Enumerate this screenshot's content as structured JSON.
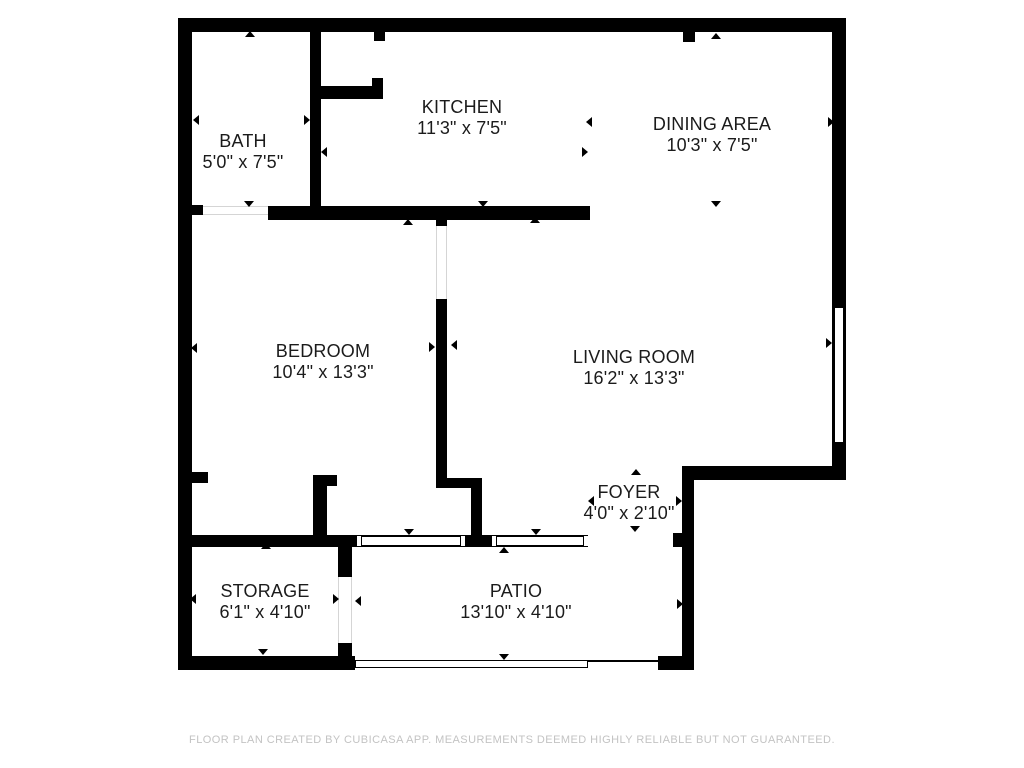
{
  "footer": {
    "disclaimer": "FLOOR PLAN CREATED BY CUBICASA APP. MEASUREMENTS DEEMED HIGHLY RELIABLE BUT NOT GUARANTEED."
  },
  "colors": {
    "wall": "#000000",
    "background": "#ffffff",
    "label_text": "#1b1b1b",
    "disclaimer_text": "#c3c3c3",
    "door_outline": "#d5d5d5"
  },
  "rooms": [
    {
      "id": "bath",
      "name": "BATH",
      "dims": "5'0\" x 7'5\"",
      "cx": 243,
      "cy": 152
    },
    {
      "id": "kitchen",
      "name": "KITCHEN",
      "dims": "11'3\" x 7'5\"",
      "cx": 462,
      "cy": 118
    },
    {
      "id": "dining-area",
      "name": "DINING AREA",
      "dims": "10'3\" x 7'5\"",
      "cx": 712,
      "cy": 135
    },
    {
      "id": "bedroom",
      "name": "BEDROOM",
      "dims": "10'4\" x 13'3\"",
      "cx": 323,
      "cy": 362
    },
    {
      "id": "living-room",
      "name": "LIVING ROOM",
      "dims": "16'2\" x 13'3\"",
      "cx": 634,
      "cy": 368
    },
    {
      "id": "foyer",
      "name": "FOYER",
      "dims": "4'0\" x 2'10\"",
      "cx": 629,
      "cy": 503
    },
    {
      "id": "storage",
      "name": "STORAGE",
      "dims": "6'1\" x 4'10\"",
      "cx": 265,
      "cy": 602
    },
    {
      "id": "patio",
      "name": "PATIO",
      "dims": "13'10\" x 4'10\"",
      "cx": 516,
      "cy": 602
    }
  ],
  "walls": [
    {
      "id": "top-wall",
      "x": 178,
      "y": 18,
      "w": 668,
      "h": 14
    },
    {
      "id": "left-wall",
      "x": 178,
      "y": 18,
      "w": 14,
      "h": 652
    },
    {
      "id": "right-wall-upper",
      "x": 832,
      "y": 18,
      "w": 14,
      "h": 285
    },
    {
      "id": "right-wall-lower",
      "x": 832,
      "y": 447,
      "w": 14,
      "h": 33
    },
    {
      "id": "foyer-step-wall",
      "x": 683,
      "y": 466,
      "w": 163,
      "h": 14
    },
    {
      "id": "foyer-right-wall",
      "x": 682,
      "y": 466,
      "w": 12,
      "h": 204
    },
    {
      "id": "entry-foot-wall",
      "x": 658,
      "y": 656,
      "w": 36,
      "h": 14
    },
    {
      "id": "storage-bottom-wall",
      "x": 178,
      "y": 656,
      "w": 177,
      "h": 14
    },
    {
      "id": "bath-kitchen-wall",
      "x": 310,
      "y": 32,
      "w": 11,
      "h": 174
    },
    {
      "id": "kitchen-closet-wall",
      "x": 321,
      "y": 86,
      "w": 62,
      "h": 13
    },
    {
      "id": "kitchen-closet-jamb",
      "x": 372,
      "y": 78,
      "w": 11,
      "h": 21
    },
    {
      "id": "kitchen-closet-stub",
      "x": 374,
      "y": 32,
      "w": 11,
      "h": 9
    },
    {
      "id": "dining-top-stub",
      "x": 683,
      "y": 32,
      "w": 12,
      "h": 10
    },
    {
      "id": "bath-door-stub",
      "x": 192,
      "y": 205,
      "w": 11,
      "h": 10
    },
    {
      "id": "kitchen-living-wall",
      "x": 268,
      "y": 206,
      "w": 322,
      "h": 14
    },
    {
      "id": "bedroom-wall-stub",
      "x": 436,
      "y": 220,
      "w": 11,
      "h": 6
    },
    {
      "id": "bedroom-living-wall",
      "x": 436,
      "y": 299,
      "w": 11,
      "h": 179
    },
    {
      "id": "foyer-jog-wall",
      "x": 436,
      "y": 478,
      "w": 46,
      "h": 10
    },
    {
      "id": "foyer-jog-wall-lower",
      "x": 471,
      "y": 488,
      "w": 11,
      "h": 47
    },
    {
      "id": "window-junction-wall",
      "x": 465,
      "y": 535,
      "w": 27,
      "h": 12
    },
    {
      "id": "storage-top-wall",
      "x": 178,
      "y": 535,
      "w": 179,
      "h": 12
    },
    {
      "id": "foyer-entry-stub",
      "x": 673,
      "y": 533,
      "w": 21,
      "h": 14
    },
    {
      "id": "bedroom-corner-wall",
      "x": 313,
      "y": 475,
      "w": 14,
      "h": 60
    },
    {
      "id": "bedroom-corner-stub",
      "x": 313,
      "y": 475,
      "w": 24,
      "h": 11
    },
    {
      "id": "bedroom-left-stub",
      "x": 192,
      "y": 472,
      "w": 16,
      "h": 11
    },
    {
      "id": "storage-patio-wall-upper",
      "x": 338,
      "y": 547,
      "w": 14,
      "h": 30
    },
    {
      "id": "storage-patio-wall-lower",
      "x": 338,
      "y": 643,
      "w": 14,
      "h": 13
    }
  ],
  "windows": [
    {
      "id": "living-room-window",
      "orient": "v",
      "x": 832,
      "y": 303,
      "w": 14,
      "h": 144
    },
    {
      "id": "patio-window-left",
      "orient": "h",
      "x": 357,
      "y": 535,
      "w": 108,
      "h": 12
    },
    {
      "id": "patio-window-right",
      "orient": "h",
      "x": 492,
      "y": 535,
      "w": 96,
      "h": 12
    }
  ],
  "doors": [
    {
      "id": "bath-door",
      "x": 203,
      "y": 206,
      "w": 65,
      "h": 9,
      "edges": "tb"
    },
    {
      "id": "bedroom-door",
      "x": 436,
      "y": 226,
      "w": 11,
      "h": 73,
      "edges": "lr"
    },
    {
      "id": "storage-door",
      "x": 338,
      "y": 577,
      "w": 14,
      "h": 66,
      "edges": "lr"
    },
    {
      "id": "foyer-entry-opening",
      "x": 588,
      "y": 535,
      "w": 85,
      "h": 12,
      "edges": "none"
    }
  ],
  "open_edges": [
    {
      "id": "patio-open-edge",
      "x": 355,
      "y": 660,
      "w": 233,
      "h": 8,
      "style": "outline"
    },
    {
      "id": "patio-open-edge-line",
      "x": 588,
      "y": 660,
      "w": 70,
      "h": 2,
      "style": "solid"
    }
  ],
  "arrows": [
    {
      "x": 250,
      "y": 34,
      "d": "up"
    },
    {
      "x": 196,
      "y": 120,
      "d": "left"
    },
    {
      "x": 307,
      "y": 120,
      "d": "right"
    },
    {
      "x": 249,
      "y": 204,
      "d": "down"
    },
    {
      "x": 324,
      "y": 152,
      "d": "left"
    },
    {
      "x": 585,
      "y": 152,
      "d": "right"
    },
    {
      "x": 483,
      "y": 204,
      "d": "down"
    },
    {
      "x": 408,
      "y": 222,
      "d": "up"
    },
    {
      "x": 535,
      "y": 220,
      "d": "up"
    },
    {
      "x": 716,
      "y": 36,
      "d": "up"
    },
    {
      "x": 589,
      "y": 122,
      "d": "left"
    },
    {
      "x": 831,
      "y": 122,
      "d": "right"
    },
    {
      "x": 716,
      "y": 204,
      "d": "down"
    },
    {
      "x": 194,
      "y": 348,
      "d": "left"
    },
    {
      "x": 432,
      "y": 347,
      "d": "right"
    },
    {
      "x": 454,
      "y": 345,
      "d": "left"
    },
    {
      "x": 829,
      "y": 343,
      "d": "right"
    },
    {
      "x": 636,
      "y": 472,
      "d": "up"
    },
    {
      "x": 591,
      "y": 501,
      "d": "left"
    },
    {
      "x": 679,
      "y": 501,
      "d": "right"
    },
    {
      "x": 635,
      "y": 529,
      "d": "down"
    },
    {
      "x": 409,
      "y": 532,
      "d": "down"
    },
    {
      "x": 536,
      "y": 532,
      "d": "down"
    },
    {
      "x": 504,
      "y": 550,
      "d": "up"
    },
    {
      "x": 266,
      "y": 546,
      "d": "up"
    },
    {
      "x": 193,
      "y": 599,
      "d": "left"
    },
    {
      "x": 336,
      "y": 599,
      "d": "right"
    },
    {
      "x": 263,
      "y": 652,
      "d": "down"
    },
    {
      "x": 358,
      "y": 601,
      "d": "left"
    },
    {
      "x": 680,
      "y": 604,
      "d": "right"
    },
    {
      "x": 504,
      "y": 657,
      "d": "down"
    }
  ]
}
